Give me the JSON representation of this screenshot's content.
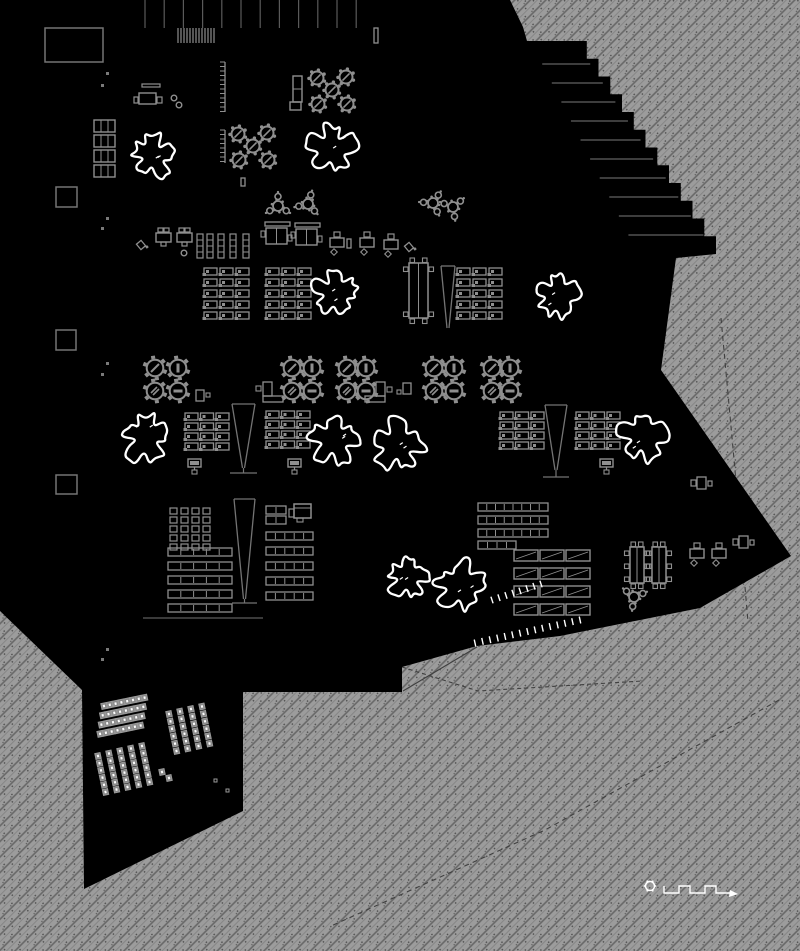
{
  "meta": {
    "type": "architectural-floor-plan",
    "canvas_w": 800,
    "canvas_h": 951
  },
  "colors": {
    "black": "#000000",
    "white": "#ffffff",
    "ink": "#8f8f8f",
    "ink_dim": "#747474",
    "ink_dark": "#555555",
    "hatch_base": "#9c9c9c",
    "hatch_line": "#676767",
    "hatch_line2": "#7d7d7d",
    "hatch_speck": "#4c4c4c",
    "site_line": "#3f3f3f"
  },
  "building": {
    "outline_pre": [
      [
        0,
        0
      ],
      [
        510,
        0
      ],
      [
        523,
        27
      ],
      [
        527,
        41
      ],
      [
        575,
        41
      ]
    ],
    "edge_steps": {
      "x1": 716,
      "y1": 254,
      "n": 12
    },
    "outline_post": [
      [
        676,
        258
      ],
      [
        661,
        370
      ],
      [
        791,
        556
      ],
      [
        700,
        608
      ],
      [
        560,
        636
      ],
      [
        477,
        646
      ],
      [
        402,
        667
      ],
      [
        402,
        692
      ],
      [
        243,
        692
      ],
      [
        243,
        811
      ],
      [
        84,
        889
      ],
      [
        82,
        690
      ],
      [
        0,
        611
      ]
    ]
  },
  "terrace_lines": {
    "count": 10,
    "y0": 64,
    "dy": 19,
    "slope": 0.662,
    "edge_x0": 575,
    "edge_y0": 41,
    "len0": 48,
    "dlen": 3
  },
  "mullions": {
    "x0": 145,
    "dx": 19.2,
    "count": 12,
    "y1": 28
  },
  "barcode": {
    "x0": 178,
    "x1": 214,
    "y": 28,
    "h": 15,
    "n": 13
  },
  "section_lines": [
    [
      143,
      618,
      263,
      618
    ]
  ],
  "service_cores": [
    [
      45,
      28,
      58,
      34
    ],
    [
      56,
      187,
      21,
      20
    ],
    [
      56,
      330,
      20,
      20
    ],
    [
      56,
      475,
      21,
      19
    ]
  ],
  "lockers": {
    "x": 94,
    "ys": [
      120,
      135,
      150,
      165
    ],
    "w": 21,
    "h": 12
  },
  "grid_markers": [
    [
      106,
      72
    ],
    [
      101,
      84
    ],
    [
      106,
      217
    ],
    [
      101,
      227
    ],
    [
      106,
      362
    ],
    [
      101,
      373
    ],
    [
      106,
      648
    ],
    [
      101,
      658
    ]
  ],
  "combs": [
    {
      "x": 225,
      "y0": 62,
      "y1": 112
    },
    {
      "x": 225,
      "y0": 130,
      "y1": 163
    }
  ],
  "trees": [
    {
      "cx": 153,
      "cy": 156,
      "r": 27,
      "seed": 3
    },
    {
      "cx": 332,
      "cy": 149,
      "r": 29,
      "seed": 7
    },
    {
      "cx": 335,
      "cy": 293,
      "r": 27,
      "seed": 11
    },
    {
      "cx": 558,
      "cy": 295,
      "r": 28,
      "seed": 13
    },
    {
      "cx": 146,
      "cy": 437,
      "r": 30,
      "seed": 17
    },
    {
      "cx": 334,
      "cy": 440,
      "r": 29,
      "seed": 19
    },
    {
      "cx": 398,
      "cy": 446,
      "r": 31,
      "seed": 23
    },
    {
      "cx": 643,
      "cy": 437,
      "r": 31,
      "seed": 29
    },
    {
      "cx": 408,
      "cy": 577,
      "r": 25,
      "seed": 31
    },
    {
      "cx": 461,
      "cy": 586,
      "r": 30,
      "seed": 37
    }
  ],
  "gear_clusters": [
    {
      "cx": 332,
      "cy": 90
    },
    {
      "cx": 253,
      "cy": 146
    }
  ],
  "gear_offsets": [
    [
      -15,
      -12
    ],
    [
      14,
      -13
    ],
    [
      0,
      0
    ],
    [
      -14,
      14
    ],
    [
      15,
      14
    ]
  ],
  "flower_tables": [
    [
      278,
      206
    ],
    [
      308,
      204
    ],
    [
      433,
      203
    ],
    [
      453,
      207
    ],
    [
      634,
      597
    ]
  ],
  "dining_clusters": [
    {
      "x": 155,
      "y": 368,
      "dx": 23
    },
    {
      "x": 292,
      "y": 368,
      "dx": 20
    },
    {
      "x": 347,
      "y": 368,
      "dx": 19
    },
    {
      "x": 434,
      "y": 368,
      "dx": 20
    },
    {
      "x": 492,
      "y": 368,
      "dx": 18
    }
  ],
  "dining_dy": 23,
  "dining_marks": [
    "slash",
    "vbar",
    "hatch",
    "hbar"
  ],
  "desk_grids": [
    {
      "x": 204,
      "y": 268,
      "cols": 3,
      "rows": 5,
      "dx": 16,
      "dy": 11
    },
    {
      "x": 266,
      "y": 268,
      "cols": 3,
      "rows": 5,
      "dx": 16,
      "dy": 11
    },
    {
      "x": 457,
      "y": 268,
      "cols": 3,
      "rows": 5,
      "dx": 16,
      "dy": 11
    },
    {
      "x": 185,
      "y": 413,
      "cols": 3,
      "rows": 4,
      "dx": 15.5,
      "dy": 10
    },
    {
      "x": 266,
      "y": 411,
      "cols": 3,
      "rows": 4,
      "dx": 15.5,
      "dy": 10
    },
    {
      "x": 500,
      "y": 412,
      "cols": 3,
      "rows": 4,
      "dx": 15.5,
      "dy": 10
    },
    {
      "x": 576,
      "y": 412,
      "cols": 3,
      "rows": 4,
      "dx": 15.5,
      "dy": 10
    }
  ],
  "square_grid": {
    "x": 170,
    "y": 508,
    "cols": 4,
    "rows": 5,
    "dx": 11,
    "dy": 9,
    "w": 7,
    "h": 6
  },
  "striped_rows": [
    {
      "x": 478,
      "y": 503,
      "w": 70,
      "rows": [
        0,
        13,
        26
      ],
      "segs": 8
    },
    {
      "x": 478,
      "y": 541,
      "w": 38,
      "rows": [
        0
      ],
      "segs": 4
    },
    {
      "x": 168,
      "y": 548,
      "w": 64,
      "rows": [
        0,
        14,
        28,
        42,
        56
      ],
      "segs": 5
    },
    {
      "x": 266,
      "y": 532,
      "w": 47,
      "rows": [
        0,
        15,
        30,
        45,
        60
      ],
      "segs": 5
    },
    {
      "x": 266,
      "y": 506,
      "w": 20,
      "rows": [
        0,
        10
      ],
      "segs": 2
    }
  ],
  "bar_columns": {
    "xs": [
      514,
      540,
      566
    ],
    "ys": [
      550,
      568,
      586,
      604
    ],
    "w": 24,
    "h": 11
  },
  "banquets": [
    {
      "x": 409,
      "y": 263,
      "w": 19,
      "h": 55,
      "side": 2
    },
    {
      "x": 630,
      "y": 547,
      "w": 14,
      "h": 36,
      "side": 3
    },
    {
      "x": 652,
      "y": 547,
      "w": 14,
      "h": 36,
      "side": 3
    }
  ],
  "ramps": [
    {
      "x": 441,
      "y": 266,
      "w": 14,
      "tip": 328,
      "base": 0
    },
    {
      "x": 232,
      "y": 404,
      "w": 23,
      "tip": 468,
      "base": 473
    },
    {
      "x": 545,
      "y": 405,
      "w": 22,
      "tip": 470,
      "base": 477
    },
    {
      "x": 234,
      "y": 499,
      "w": 21,
      "tip": 599,
      "base": 603
    }
  ],
  "monitors": [
    [
      188,
      459
    ],
    [
      288,
      459
    ],
    [
      600,
      459
    ]
  ],
  "mdesks": [
    [
      330,
      238
    ],
    [
      360,
      238
    ],
    [
      384,
      240
    ],
    [
      690,
      549
    ],
    [
      712,
      549
    ]
  ],
  "desk2": [
    {
      "x": 156,
      "y": 233,
      "stool": false
    },
    {
      "x": 177,
      "y": 233,
      "stool": true
    }
  ],
  "desk_top": {
    "bar": [
      142,
      84,
      18,
      3
    ],
    "table": [
      139,
      93,
      17,
      11
    ],
    "sq1": [
      157,
      97,
      5,
      6
    ],
    "sq2": [
      134,
      97,
      4,
      6
    ]
  },
  "stools": [
    [
      174,
      98
    ],
    [
      179,
      105
    ],
    [
      184,
      253
    ]
  ],
  "diag_chairs": [
    [
      141,
      245
    ],
    [
      409,
      247
    ]
  ],
  "mini_rects": [
    [
      347,
      239,
      4,
      9
    ],
    [
      241,
      178,
      4,
      8
    ],
    [
      374,
      28,
      4,
      15
    ]
  ],
  "shelves": {
    "xs": [
      197,
      207,
      218,
      230,
      243
    ],
    "y": 234,
    "w": 6,
    "h": 24
  },
  "double_desks": [
    [
      265,
      222
    ],
    [
      295,
      223
    ]
  ],
  "l_locker": [
    292,
    76
  ],
  "copier": [
    294,
    504
  ],
  "counters": [
    {
      "type": "L",
      "sq": [
        256,
        386,
        5,
        5
      ],
      "v": [
        263,
        382,
        9,
        14
      ],
      "hh": [
        263,
        396,
        20,
        6
      ]
    },
    {
      "type": "L",
      "sq": [
        387,
        387,
        5,
        5
      ],
      "v": [
        376,
        382,
        9,
        14
      ],
      "hh": [
        365,
        396,
        20,
        6
      ]
    },
    {
      "type": "door",
      "r": [
        403,
        383,
        8,
        11
      ],
      "sq": [
        397,
        390,
        4,
        4
      ]
    },
    {
      "type": "door",
      "r": [
        196,
        390,
        8,
        11
      ],
      "sq": [
        206,
        393,
        4,
        4
      ]
    }
  ],
  "right_desks": [
    {
      "x": 697,
      "y": 477
    },
    {
      "x": 739,
      "y": 536
    }
  ],
  "auditorium": {
    "blocks": [
      {
        "ox": 104,
        "oy": 706,
        "ax": 5.8,
        "ay": -1.2,
        "cols": 8,
        "bx": -1.3,
        "by": 9.3,
        "rows": 4,
        "rot": -12
      },
      {
        "ox": 169,
        "oy": 714,
        "ax": 11,
        "ay": -2.5,
        "cols": 4,
        "bx": 1.5,
        "by": 7.4,
        "rows": 6,
        "rot": -12
      },
      {
        "ox": 98,
        "oy": 756,
        "ax": 11,
        "ay": -2.5,
        "cols": 5,
        "bx": 1.5,
        "by": 7.2,
        "rows": 6,
        "rot": -12
      }
    ],
    "extra_chairs": [
      [
        162,
        772
      ],
      [
        169,
        778
      ]
    ],
    "spots": [
      [
        214,
        779
      ],
      [
        226,
        789
      ]
    ]
  },
  "tick_rows": [
    {
      "x1": 492,
      "y1": 600,
      "x2": 541,
      "y2": 584,
      "n": 8
    },
    {
      "x1": 475,
      "y1": 643,
      "x2": 580,
      "y2": 620,
      "n": 15
    }
  ],
  "site_paths": [
    {
      "pts": [
        [
          721,
          318
        ],
        [
          735,
          470
        ],
        [
          748,
          622
        ]
      ],
      "dash": "5,4"
    },
    {
      "pts": [
        [
          779,
          700
        ],
        [
          545,
          830
        ],
        [
          331,
          926
        ]
      ],
      "dash": "5,4"
    },
    {
      "pts": [
        [
          402,
          667
        ],
        [
          478,
          691
        ],
        [
          642,
          681
        ]
      ],
      "dash": "4,3"
    },
    {
      "pts": [
        [
          399,
          660
        ],
        [
          478,
          642
        ]
      ],
      "dash": "4,3"
    },
    {
      "pts": [
        [
          403,
          691
        ],
        [
          477,
          647
        ]
      ],
      "dash": ""
    }
  ],
  "scale_bar": {
    "cx": 650,
    "cy": 886,
    "r": 4.5,
    "path": "M664,886 v7 h15 v-7 h11 v7 h15 v-7 h11 v7 h14",
    "arrow": [
      [
        730,
        890
      ],
      [
        738,
        894
      ],
      [
        729,
        897
      ]
    ]
  }
}
